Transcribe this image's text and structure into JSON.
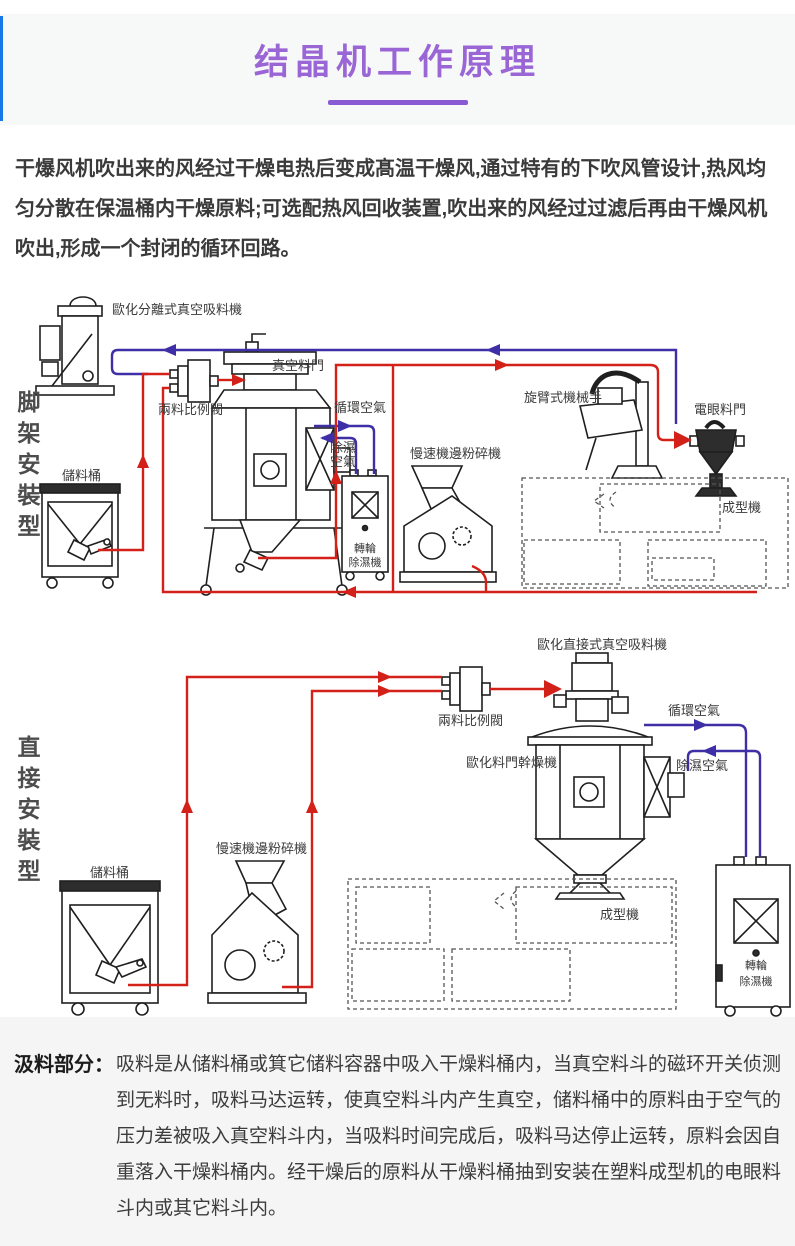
{
  "header": {
    "title": "结晶机工作原理"
  },
  "intro": {
    "text": "干爆风机吹出来的风经过干燥电热后变成髙温干燥风,通过特有的下吹风管设计,热风均匀分散在保温桶内干燥原料;可选配热风回收装置,吹出来的风经过过滤后再由干燥风机吹出,形成一个封闭的循环回路。"
  },
  "diagram1": {
    "side_label": "脚架安裝型",
    "labels": {
      "loader": "歐化分離式真空吸料機",
      "hopper": "真空料門",
      "valve": "兩料比例閥",
      "circulating_air": "循環空氣",
      "dehumidified_air_1": "除濕",
      "dehumidified_air_2": "空氣",
      "storage_bin": "儲料桶",
      "dehumidifier_1": "轉輪",
      "dehumidifier_2": "除濕機",
      "granulator": "慢速機邊粉碎機",
      "robot": "旋臂式機械手",
      "eye_hopper": "電眼料門",
      "molding": "成型機"
    }
  },
  "diagram2": {
    "side_label": "直接安裝型",
    "labels": {
      "loader": "歐化直接式真空吸料機",
      "valve": "兩料比例閥",
      "dryer": "歐化料門幹燥機",
      "circulating_air": "循環空氣",
      "dehumidified_air": "除濕空氣",
      "storage_bin": "儲料桶",
      "granulator": "慢速機邊粉碎機",
      "molding": "成型機",
      "dehumidifier_1": "轉輪",
      "dehumidifier_2": "除濕機"
    }
  },
  "suction": {
    "heading": "汲料部分：",
    "body": "吸料是从储料桶或箕它储料容器中吸入干燥料桶内，当真空料斗的磁环开关侦测到无料时，吸料马达运转，使真空料斗内产生真空，储料桶中的原料由于空气的压力差被吸入真空料斗内，当吸料时间完成后，吸料马达停止运转，原料会因自重落入干燥料桶内。经干燥后的原料从干燥料桶抽到安装在塑料成型机的电眼料斗内或其它料斗内。"
  },
  "colors": {
    "accent_purple": "#9a66d6",
    "underline_purple": "#8a5ad4",
    "left_bar_blue": "#1677e8",
    "flow_red": "#d32018",
    "flow_blue": "#3e2fa6",
    "header_bg": "#f7f8f8",
    "bottom_bg": "#f5f5f6"
  }
}
